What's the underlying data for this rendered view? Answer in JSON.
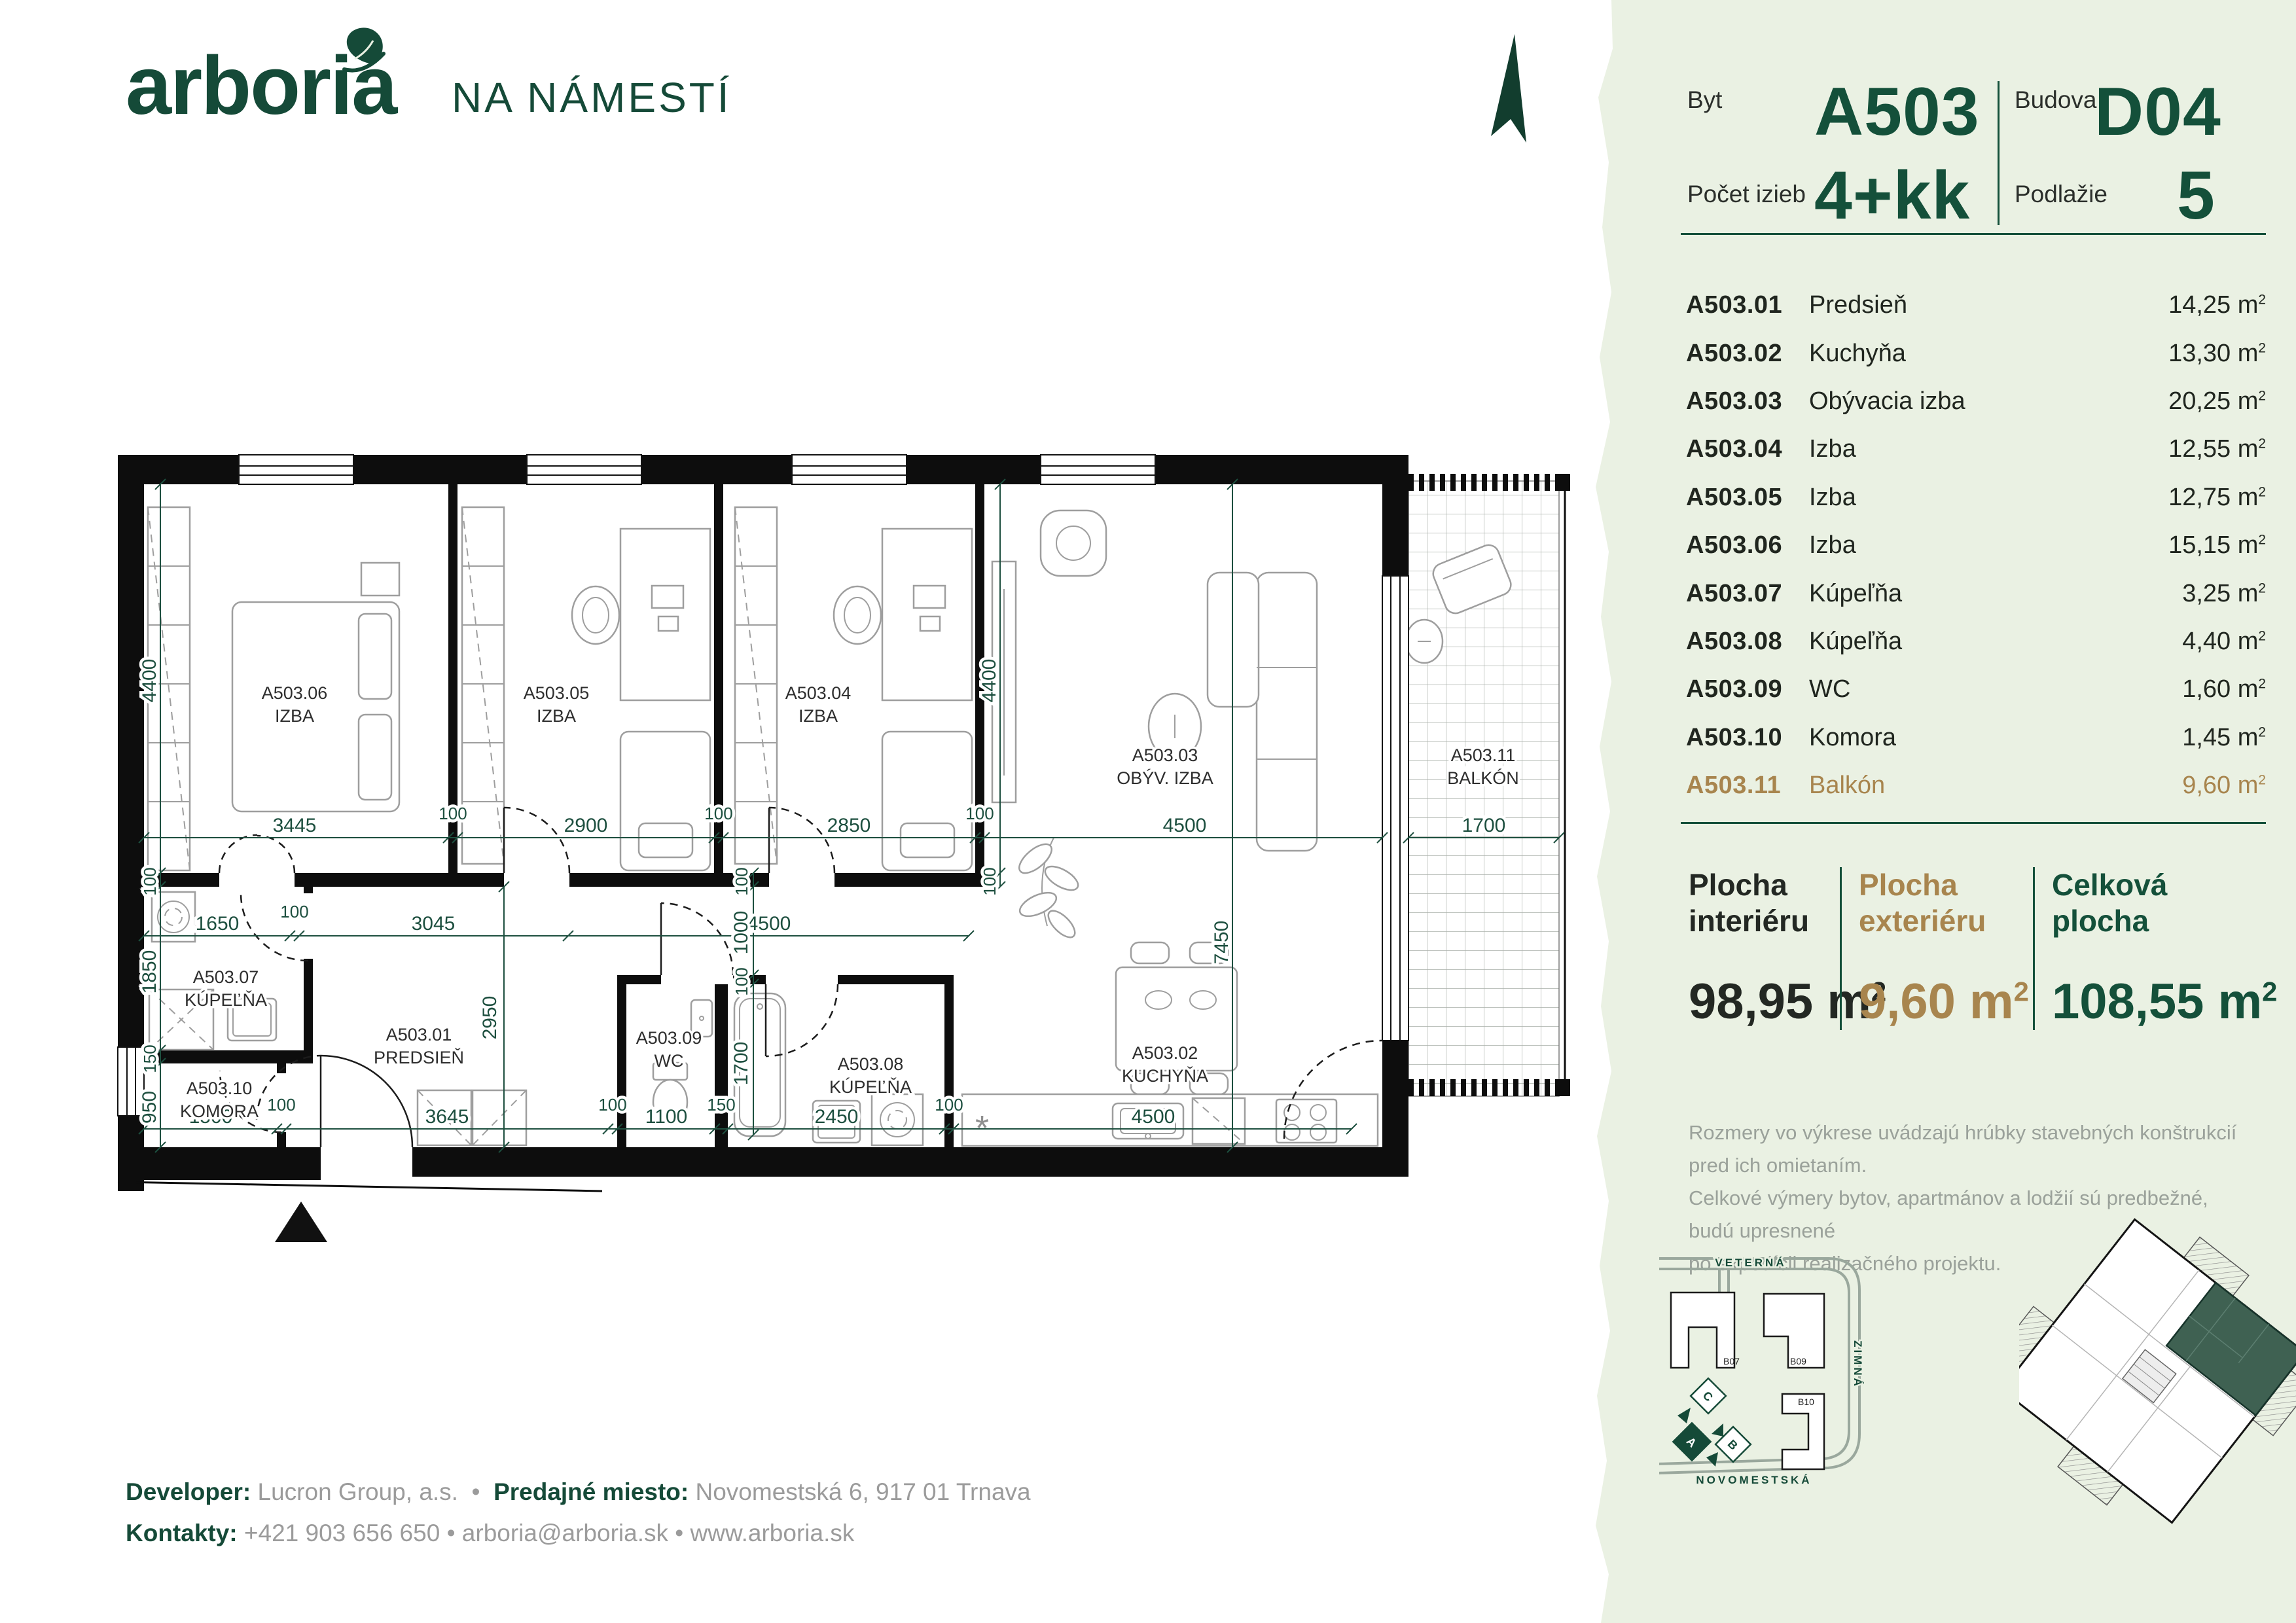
{
  "brand": {
    "logo": "arboria",
    "project": "NA NÁMESTÍ"
  },
  "header": {
    "byt_label": "Byt",
    "byt_value": "A503",
    "budova_label": "Budova",
    "budova_value": "D04",
    "pocet_label": "Počet izieb",
    "pocet_value": "4+kk",
    "podlazie_label": "Podlažie",
    "podlazie_value": "5"
  },
  "units": {
    "m": "m",
    "sup": "2"
  },
  "rooms": [
    {
      "code": "A503.01",
      "name": "Predsieň",
      "area": "14,25"
    },
    {
      "code": "A503.02",
      "name": "Kuchyňa",
      "area": "13,30"
    },
    {
      "code": "A503.03",
      "name": "Obývacia izba",
      "area": "20,25"
    },
    {
      "code": "A503.04",
      "name": "Izba",
      "area": "12,55"
    },
    {
      "code": "A503.05",
      "name": "Izba",
      "area": "12,75"
    },
    {
      "code": "A503.06",
      "name": "Izba",
      "area": "15,15"
    },
    {
      "code": "A503.07",
      "name": "Kúpeľňa",
      "area": "3,25"
    },
    {
      "code": "A503.08",
      "name": "Kúpeľňa",
      "area": "4,40"
    },
    {
      "code": "A503.09",
      "name": "WC",
      "area": "1,60"
    },
    {
      "code": "A503.10",
      "name": "Komora",
      "area": "1,45"
    },
    {
      "code": "A503.11",
      "name": "Balkón",
      "area": "9,60"
    }
  ],
  "summary": {
    "interior": {
      "line1": "Plocha",
      "line2": "interiéru",
      "value": "98,95"
    },
    "exterior": {
      "line1": "Plocha",
      "line2": "exteriéru",
      "value": "9,60"
    },
    "total": {
      "line1": "Celková",
      "line2": "plocha",
      "value": "108,55"
    }
  },
  "disclaimer": {
    "line1": "Rozmery vo výkrese uvádzajú hrúbky stavebných konštrukcií pred ich omietaním.",
    "line2": "Celkové výmery bytov, apartmánov a lodžií sú predbežné, budú upresnené",
    "line3": "po expedícii realizačného projektu."
  },
  "footer": {
    "developer_label": "Developer:",
    "developer_value": "Lucron Group, a.s.",
    "sep": "•",
    "predajne_label": "Predajné miesto:",
    "predajne_value": "Novomestská 6, 917 01  Trnava",
    "kontakty_label": "Kontakty:",
    "kontakty_value": "+421 903 656 650 • arboria@arboria.sk • www.arboria.sk"
  },
  "plan": {
    "rooms": [
      {
        "code": "A503.06",
        "name": "IZBA"
      },
      {
        "code": "A503.05",
        "name": "IZBA"
      },
      {
        "code": "A503.04",
        "name": "IZBA"
      },
      {
        "code": "A503.03",
        "name": "OBÝV. IZBA"
      },
      {
        "code": "A503.11",
        "name": "BALKÓN"
      },
      {
        "code": "A503.07",
        "name": "KÚPEĽŇA"
      },
      {
        "code": "A503.01",
        "name": "PREDSIEŇ"
      },
      {
        "code": "A503.09",
        "name": "WC"
      },
      {
        "code": "A503.08",
        "name": "KÚPEĽŇA"
      },
      {
        "code": "A503.02",
        "name": "KUCHYŇA"
      },
      {
        "code": "A503.10",
        "name": "KOMORA"
      }
    ],
    "dims": [
      "3445",
      "100",
      "2900",
      "100",
      "2850",
      "100",
      "4500",
      "1700",
      "4400",
      "4400",
      "7450",
      "1650",
      "100",
      "3045",
      "4500",
      "1000",
      "100",
      "100",
      "1700",
      "100",
      "1850",
      "150",
      "950",
      "1500",
      "100",
      "3645",
      "100",
      "1100",
      "150",
      "2450",
      "100",
      "4500",
      "2950",
      "100"
    ],
    "kitchen_star": "*"
  },
  "sitemap": {
    "street_top": "VETERNÁ",
    "street_right": "ZIMNÁ",
    "street_bottom": "NOVOMESTSKÁ",
    "b07": "B07",
    "b09": "B09",
    "b10": "B10",
    "block_a": "A",
    "block_b": "B",
    "block_c": "C"
  },
  "colors": {
    "brand": "#154a38",
    "gold": "#a8854e",
    "panel": "#eaf1e3",
    "dim": "#1d4f3f",
    "unit_highlight": "#3f6152"
  }
}
